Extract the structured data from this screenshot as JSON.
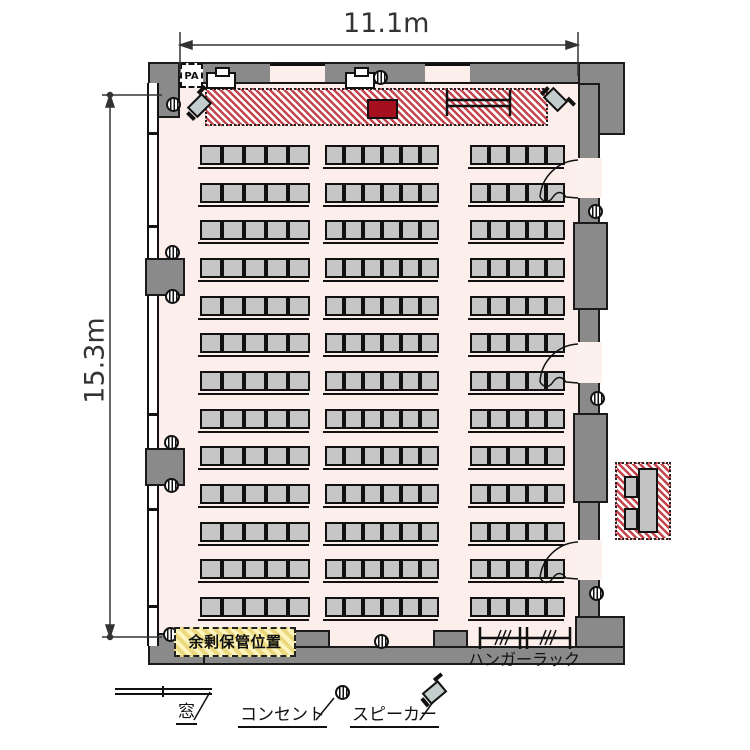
{
  "dimensions": {
    "width_label": "11.1m",
    "height_label": "15.3m"
  },
  "labels": {
    "pa": "PA",
    "storage": "余剰保管位置",
    "hanger_rack": "ハンガーラック"
  },
  "legend": {
    "items": [
      {
        "icon": "window-icon",
        "label": "窓"
      },
      {
        "icon": "outlet-icon",
        "label": "コンセント"
      },
      {
        "icon": "speaker-icon",
        "label": "スピーカー"
      }
    ]
  },
  "seating": {
    "rows": 13,
    "groups": [
      {
        "name": "left-bank",
        "seats_per_row": 5
      },
      {
        "name": "center-bank",
        "seats_per_row": 6
      },
      {
        "name": "right-bank",
        "seats_per_row": 5
      }
    ],
    "total_seats": 208
  },
  "features": {
    "doors_right_wall": 3,
    "window_wall": "left",
    "stage_position": "top",
    "outside_table": "reception table with 2 chairs, right side"
  },
  "colors": {
    "room_fill": "#fcefeb",
    "wall": "#8a8a8a",
    "seat": "#c6c6c6",
    "stage_stripe": "#c4454c",
    "podium": "#a50f1e",
    "storage_label_bg": "#fdf5bd"
  }
}
